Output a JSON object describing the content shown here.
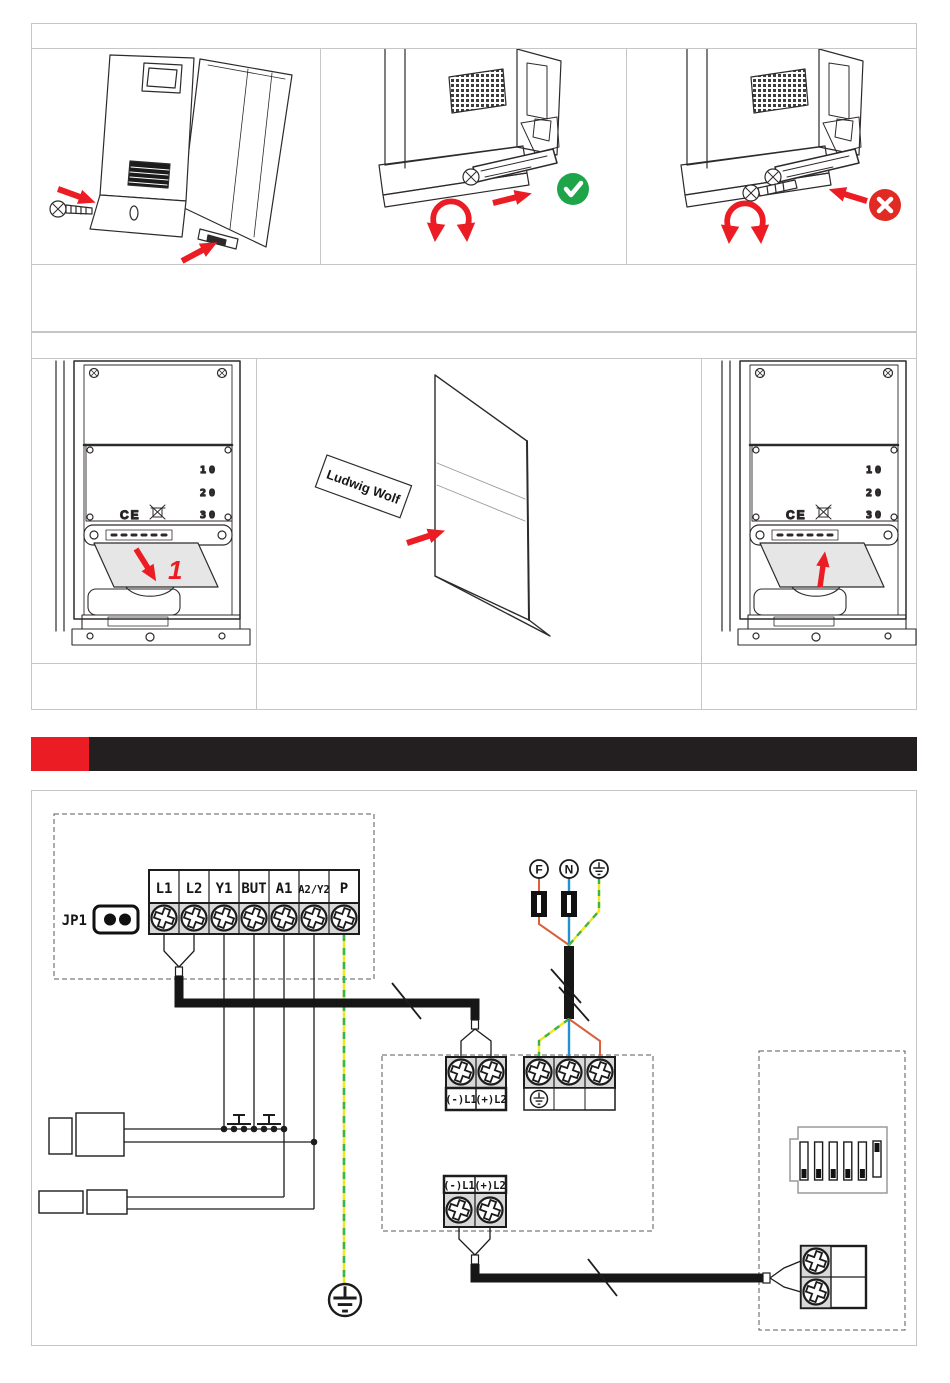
{
  "colors": {
    "accent_red": "#ec1c24",
    "ok_green": "#1ea449",
    "error_red": "#e02a22",
    "wire_orange": "#d9603a",
    "wire_blue": "#2391d0",
    "wire_green": "#3cb44a",
    "wire_yellow": "#f0e71c",
    "bar_black": "#231f20",
    "terminal_gray": "#d8d8d8"
  },
  "illustrations": {
    "scale_marks": [
      "10",
      "20",
      "30"
    ],
    "ce_mark": "CE",
    "step_number": "1",
    "name_plate": "Ludwig Wolf"
  },
  "wiring": {
    "jumper_label": "JP1",
    "controller_terminals": [
      "L1",
      "L2",
      "Y1",
      "BUT",
      "A1",
      "A2/Y2",
      "P"
    ],
    "supply_terminals": [
      "F",
      "N"
    ],
    "bus_block_upper": [
      "(-)L1",
      "(+)L2"
    ],
    "bus_block_lower": [
      "(-)L1",
      "(+)L2"
    ]
  }
}
